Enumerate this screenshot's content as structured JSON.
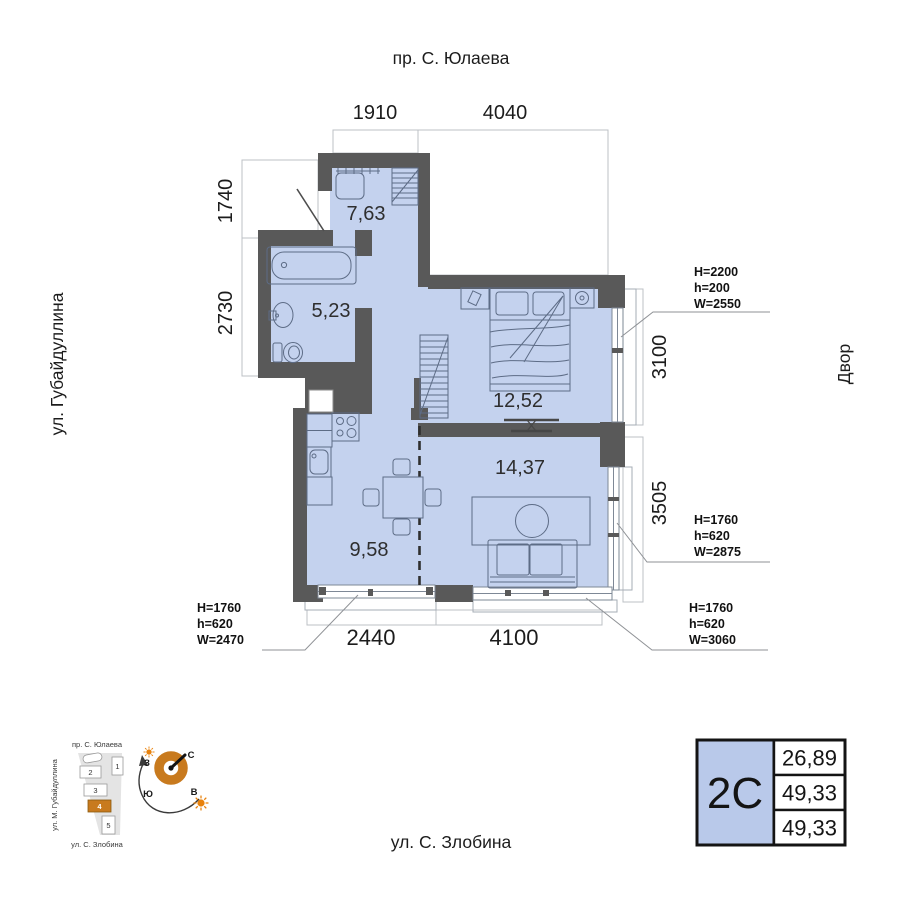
{
  "streets": {
    "top": "пр. С. Юлаева",
    "left": "ул. Губайдуллина",
    "right": "Двор",
    "bottom": "ул. С. Злобина"
  },
  "dimensions": {
    "top_left": "1910",
    "top_right": "4040",
    "left_upper": "1740",
    "left_lower": "2730",
    "right_upper": "3100",
    "right_lower": "3505",
    "bottom_left": "2440",
    "bottom_right": "4100"
  },
  "rooms": {
    "hallway": "7,63",
    "bathroom": "5,23",
    "bedroom": "12,52",
    "living": "14,37",
    "kitchen": "9,58"
  },
  "window_specs": {
    "bedroom_right": {
      "l1": "H=2200",
      "l2": "h=200",
      "l3": "W=2550"
    },
    "living_right": {
      "l1": "H=1760",
      "l2": "h=620",
      "l3": "W=2875"
    },
    "living_bottom": {
      "l1": "H=1760",
      "l2": "h=620",
      "l3": "W=3060"
    },
    "kitchen_bottom": {
      "l1": "H=1760",
      "l2": "h=620",
      "l3": "W=2470"
    }
  },
  "info_card": {
    "type": "2С",
    "row1": "26,89",
    "row2": "49,33",
    "row3": "49,33"
  },
  "minimap": {
    "street_top": "пр. С. Юлаева",
    "street_left": "ул. М. Губайдуллина",
    "street_bottom": "ул. С. Злобина",
    "b1": "1",
    "b2": "2",
    "b3": "3",
    "b4": "4",
    "b5": "5"
  },
  "compass": {
    "north": "С",
    "south": "Ю",
    "west": "З",
    "east": "В"
  },
  "colors": {
    "room_fill": "#c4d2ee",
    "wall": "#595959",
    "accent_orange": "#c87a1e",
    "card_fill": "#b9c9ea"
  }
}
